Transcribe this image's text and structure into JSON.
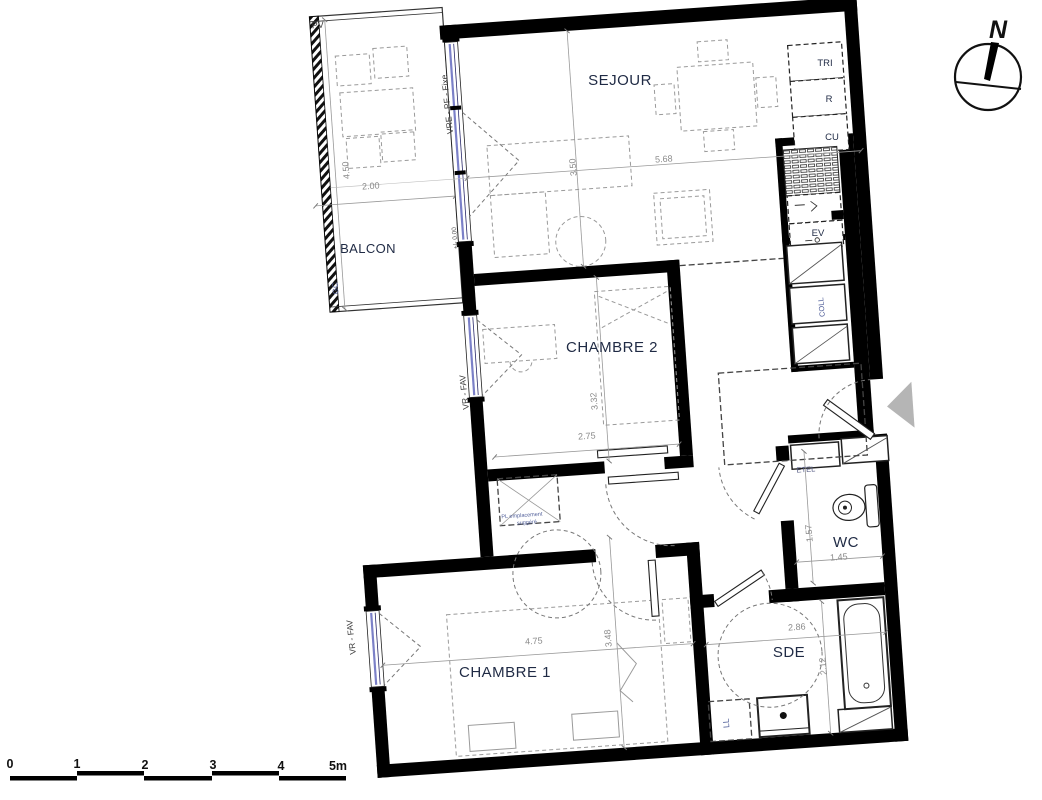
{
  "labels": {
    "sejour": "SEJOUR",
    "balcon": "BALCON",
    "chambre2": "CHAMBRE 2",
    "chambre1": "CHAMBRE 1",
    "wc": "WC",
    "sde": "SDE",
    "tri": "TRI",
    "r": "R",
    "cu": "CU",
    "ev": "EV",
    "coll": "COLL",
    "etel": "ETEL",
    "ll": "LL",
    "pv": "PV",
    "gc": "GC",
    "window_sejour": "VRE - PF - Fixe",
    "window_chambre2": "VR - FAV",
    "window_chambre1": "VR - FAV",
    "level": "+/- 0.00",
    "closet_note_line1": "PL emplacement",
    "closet_note_line2": "suggéré",
    "north": "N"
  },
  "dimensions": {
    "balcon": {
      "width": "2.00",
      "height": "4.50"
    },
    "sejour": {
      "width": "5.68",
      "height": "3.50"
    },
    "chambre2": {
      "width": "2.75",
      "height": "3.32"
    },
    "chambre1": {
      "width": "4.75",
      "height": "3.48"
    },
    "wc": {
      "width": "1.45",
      "height": "1.57"
    },
    "sde": {
      "width": "2.86",
      "height": "2.12"
    }
  },
  "scale_bar": {
    "labels": [
      "0",
      "1",
      "2",
      "3",
      "4",
      "5m"
    ]
  },
  "colors": {
    "wall": "#000000",
    "room_label": "#1f2a44",
    "dimension_text": "#8a8a8a",
    "window_glazing": "#7b80c8",
    "annotation": "#52609a",
    "entry_arrow": "#b5b5b5"
  }
}
